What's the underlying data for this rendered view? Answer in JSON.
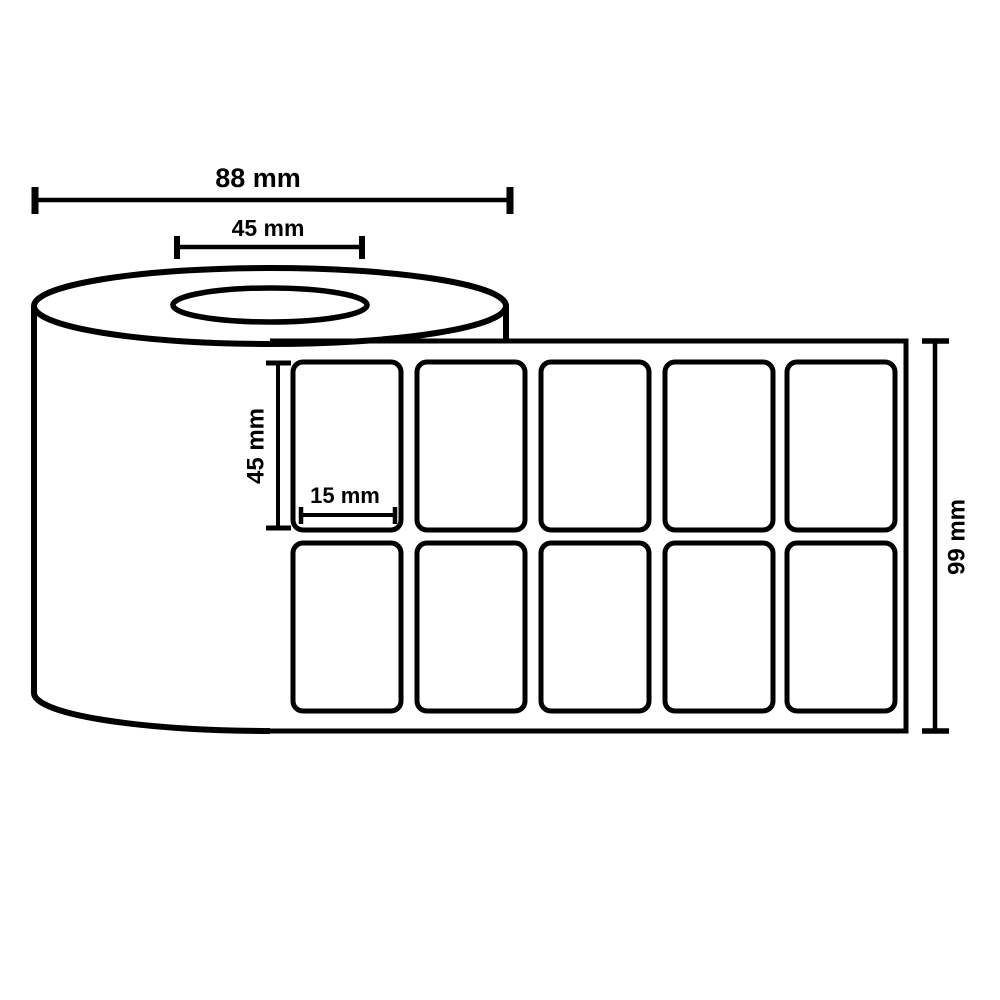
{
  "diagram": {
    "dimensions": {
      "roll_width": "88 mm",
      "core_width": "45 mm",
      "label_height": "45 mm",
      "label_width": "15 mm",
      "strip_height": "99 mm"
    },
    "labels_grid": {
      "rows": 2,
      "columns": 5
    },
    "colors": {
      "line": "#000000",
      "background": "#ffffff"
    }
  }
}
